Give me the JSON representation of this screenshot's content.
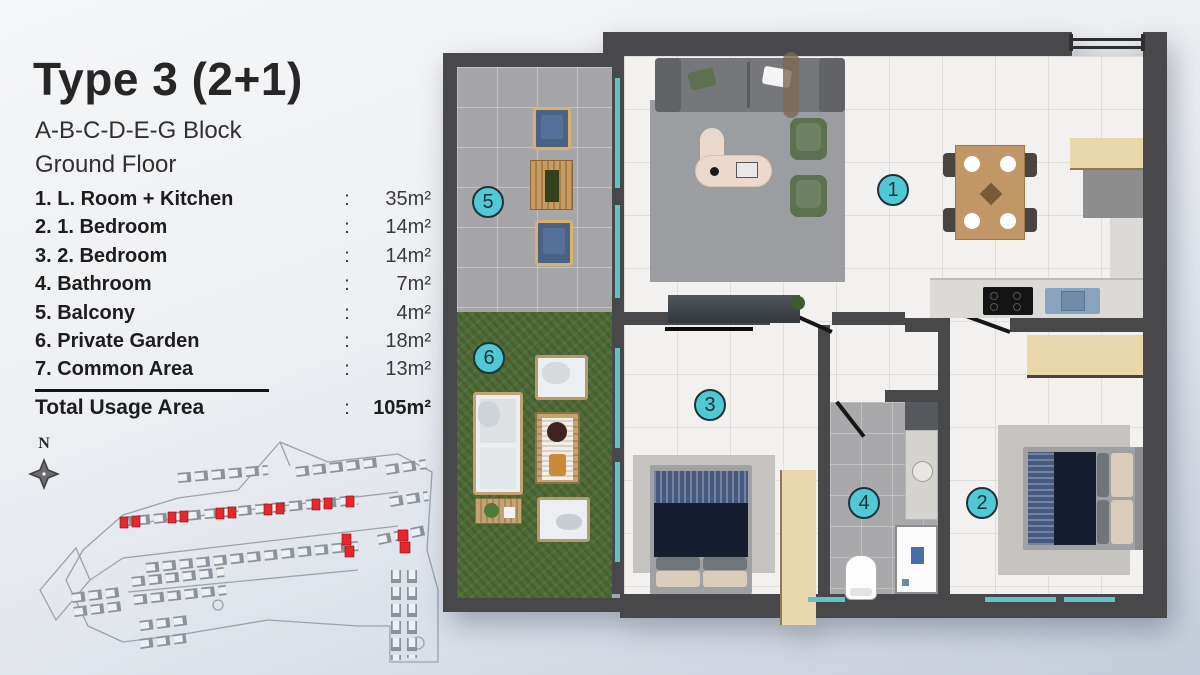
{
  "info": {
    "title": "Type 3 (2+1)",
    "block_line": "A-B-C-D-E-G Block",
    "floor_line": "Ground Floor",
    "separator": ":",
    "rooms": [
      {
        "label": "1. L. Room + Kitchen",
        "area": "35m²"
      },
      {
        "label": "2. 1. Bedroom",
        "area": "14m²"
      },
      {
        "label": "3. 2. Bedroom",
        "area": "14m²"
      },
      {
        "label": "4. Bathroom",
        "area": "7m²"
      },
      {
        "label": "5. Balcony",
        "area": "4m²"
      },
      {
        "label": "6. Private Garden",
        "area": "18m²"
      },
      {
        "label": "7. Common Area",
        "area": "13m²"
      }
    ],
    "total": {
      "label": "Total Usage Area",
      "area": "105m²"
    }
  },
  "compass": {
    "label": "N"
  },
  "plan": {
    "markers": [
      {
        "number": "1",
        "room": "living-room-kitchen"
      },
      {
        "number": "2",
        "room": "bedroom-1"
      },
      {
        "number": "3",
        "room": "bedroom-2"
      },
      {
        "number": "4",
        "room": "bathroom"
      },
      {
        "number": "5",
        "room": "balcony"
      },
      {
        "number": "6",
        "room": "private-garden"
      }
    ]
  },
  "colors": {
    "accent-teal": "#4fc9d3",
    "marker-border": "#22303d",
    "highlight-red": "#e8262b",
    "wall-dark": "#48484a",
    "garden-green": "#4e6a35",
    "window-teal": "#5fc4c6",
    "marble": "#f2f1ef",
    "balcony-gray": "#a6a6a8",
    "wood": "#c29768",
    "cabinet-beige": "#e9d6ab",
    "navy-bed": "#161d2e"
  }
}
